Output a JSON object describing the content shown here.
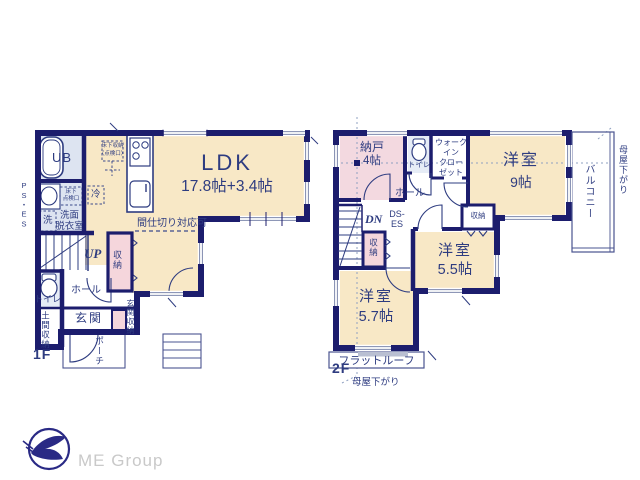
{
  "floor1": {
    "label": "1F",
    "ldk_name": "LDK",
    "ldk_size": "17.8帖+3.4帖",
    "partition_note": "間仕切り対応可",
    "unit_bath": "UB",
    "washroom_1": "洗面",
    "washroom_2": "脱衣室",
    "laundry": "洗",
    "refrigerator": "冷",
    "underfloor_storage_1": "床下収納",
    "underfloor_storage_2": "（点検口）",
    "underfloor_hatch_1": "床下",
    "underfloor_hatch_2": "点検口",
    "pipe_space": "PS・ES",
    "stairs_up": "UP",
    "closet": "収納",
    "hall": "ホール",
    "toilet": "トイレ",
    "doma_storage": "土間収納",
    "entrance": "玄関",
    "entrance_storage": "玄関収納",
    "porch": "ポーチ"
  },
  "floor2": {
    "label": "2F",
    "storeroom_name": "納戸",
    "storeroom_size": "4帖",
    "toilet": "トイレ",
    "wic_1": "ウォーク",
    "wic_2": "イン",
    "wic_3": "クロー",
    "wic_4": "ゼット",
    "room9_name": "洋室",
    "room9_size": "9帖",
    "balcony": "バルコニー",
    "hall": "ホール",
    "stairs_down": "DN",
    "duct_1": "DS-",
    "duct_2": "ES",
    "closet_a": "収納",
    "closet_b": "収納",
    "room55_name": "洋室",
    "room55_size": "5.5帖",
    "room57_name": "洋室",
    "room57_size": "5.7帖",
    "flat_roof": "フラットルーフ",
    "eaves_right": "母屋下がり",
    "eaves_bottom": "母屋下がり"
  },
  "logo": {
    "company": "ME Group"
  },
  "colors": {
    "wall": "#1c1d6d",
    "room_beige": "#f8e8c6",
    "service_blue": "#dde4f1",
    "closet_pink": "#f5d6dc",
    "text_navy": "#2e3c80"
  }
}
